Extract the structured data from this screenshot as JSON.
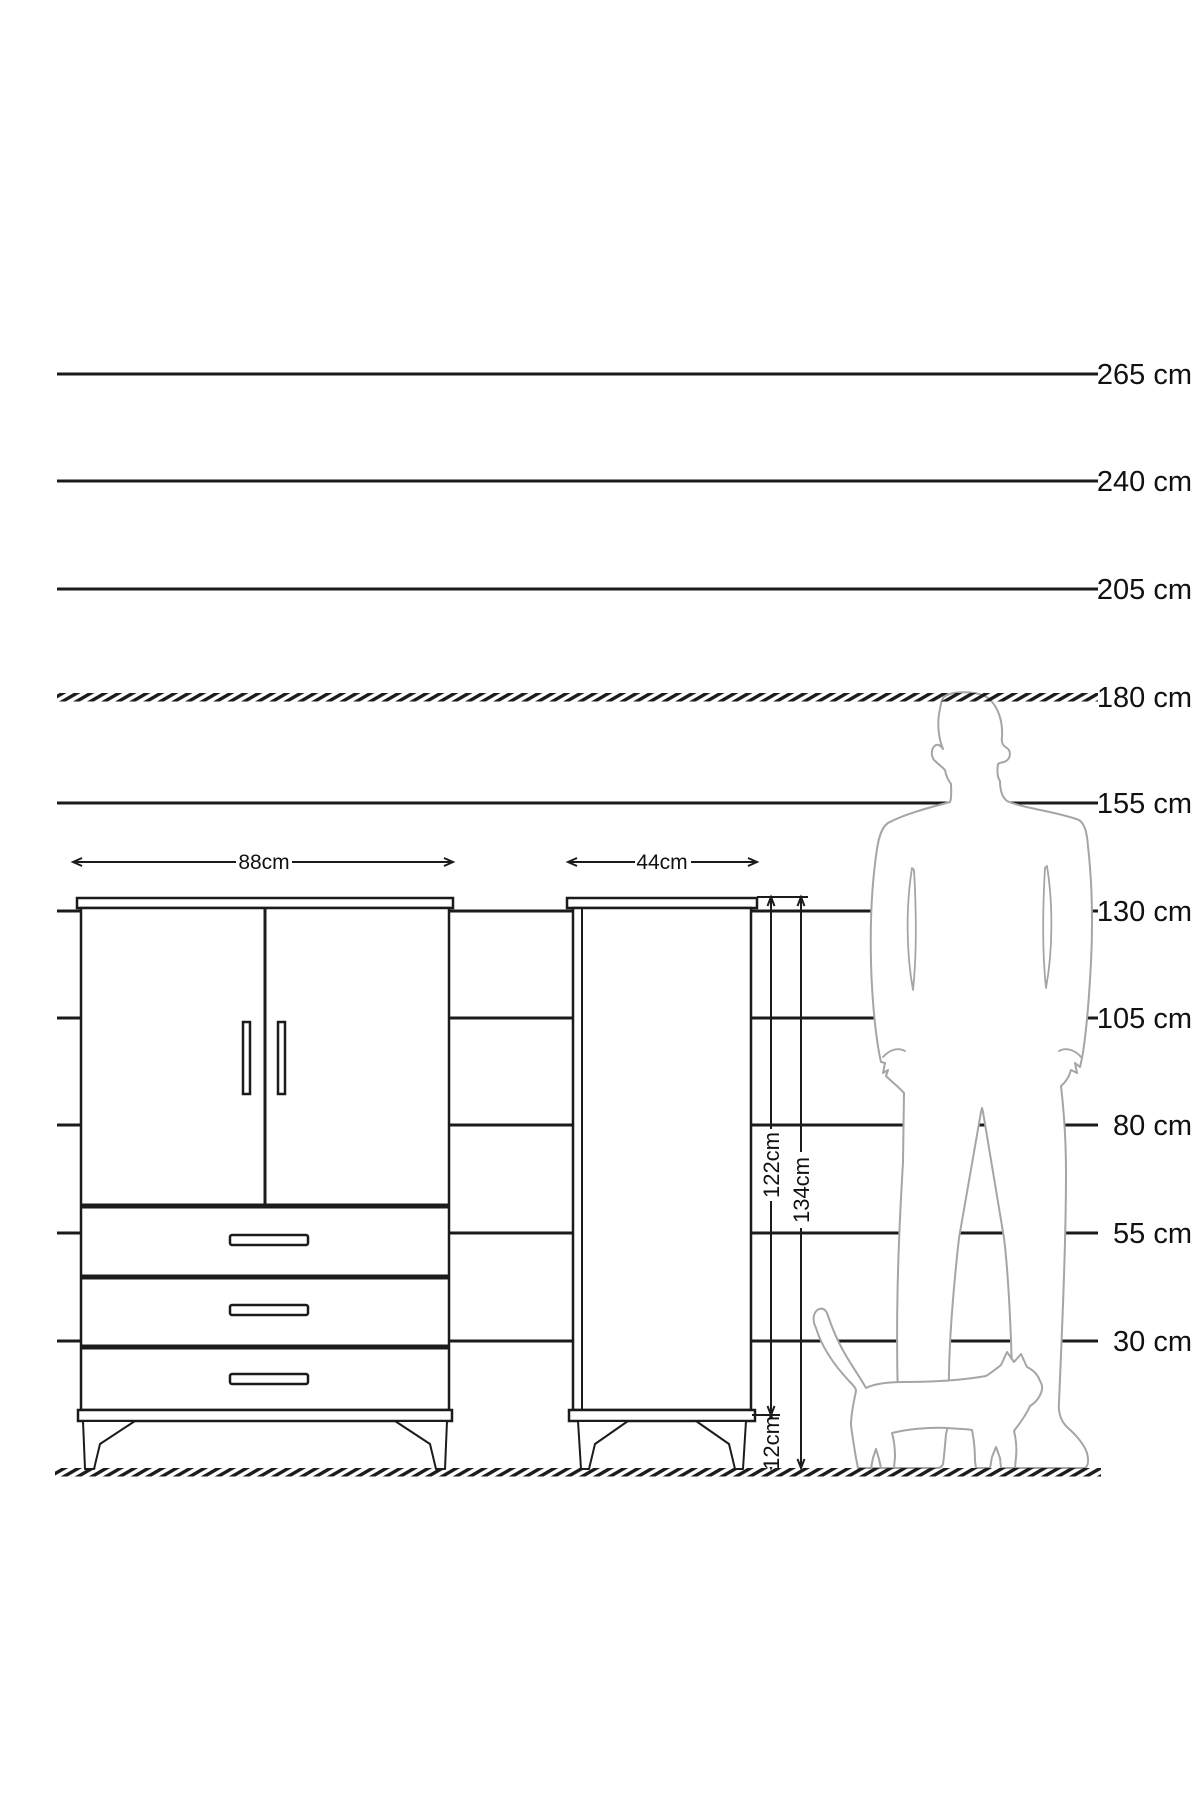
{
  "ruler": {
    "labels": [
      "265 cm",
      "240 cm",
      "205 cm",
      "180 cm",
      "155 cm",
      "130 cm",
      "105 cm",
      "80 cm",
      "55 cm",
      "30 cm"
    ]
  },
  "dimensions": {
    "wardrobe_width": "88cm",
    "cabinet_width": "44cm",
    "cabinet_body_height": "122cm",
    "cabinet_total_height": "134cm",
    "cabinet_leg_height": "12cm"
  },
  "colors": {
    "line": "#1b1b1b",
    "figure_outline": "#a5a5a5",
    "background": "#ffffff"
  }
}
